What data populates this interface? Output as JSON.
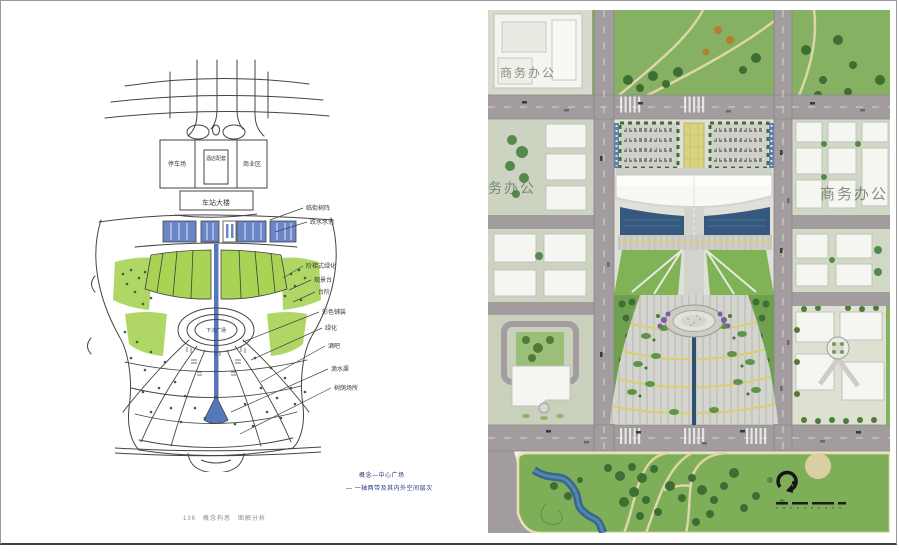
{
  "page": {
    "captions": {
      "concept_line1": "概念—中心广场",
      "concept_line2": "— 一轴两带及其内外空间层次",
      "footer": "136　概念构思　图解分析"
    }
  },
  "sketch": {
    "zone_labels": {
      "parking": "停车场",
      "hotel": "酒店配套",
      "commerce": "商业区",
      "main_building": "车站大楼",
      "sunken_plaza": "下沉广场"
    },
    "annotations": [
      {
        "label": "临街树阵"
      },
      {
        "label": "跌水水池"
      },
      {
        "label": "阶梯式绿化"
      },
      {
        "label": "观景台"
      },
      {
        "label": "台阶"
      },
      {
        "label": "彩色铺装"
      },
      {
        "label": "绿化"
      },
      {
        "label": "酒吧"
      },
      {
        "label": "滴水渠"
      },
      {
        "label": "树荫场所"
      }
    ]
  },
  "plan": {
    "labels": {
      "block_top_left": "商务办公",
      "block_left": "商务办公",
      "block_right": "商务办公"
    },
    "colors": {
      "road": "#a29c9e",
      "park_green": "#85b061",
      "pool_blue": "#35587f",
      "axis_blue": "#2e4e74",
      "paving": "#d5d5cf",
      "court_yellow": "#d8d37e"
    }
  }
}
